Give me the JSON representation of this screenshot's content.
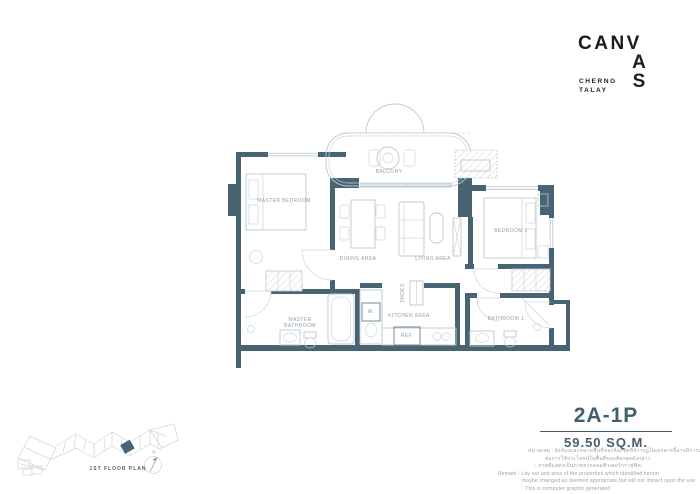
{
  "brand": {
    "logo_row": "CANV",
    "logo_stack_a": "A",
    "logo_stack_s": "S",
    "subtitle_line1": "CHERNG",
    "subtitle_line2": "TALAY"
  },
  "unit": {
    "code": "2A-1P",
    "area": "59.50 SQ.M."
  },
  "rooms": {
    "master_bedroom": "MASTER BEDROOM",
    "balcony": "BALCONY",
    "dining_area": "DINING AREA",
    "living_area": "LIVING AREA",
    "bedroom_1": "BEDROOM 1",
    "master_bathroom_line1": "MASTER",
    "master_bathroom_line2": "BATHROOM",
    "kitchen_area": "KITCHEN AREA",
    "bathroom_1": "BATHROOM 1",
    "shoes": "SHOES",
    "washer": "W.",
    "refrigerator": "REF."
  },
  "remark": {
    "thai_line1": "หมายเหตุ : ผังห้องและขนาดพื้นที่ของห้องชุดที่ปรากฏในเอกสารนี้อาจมีการเปลี่ยนแปลงได้ตามความเหมาะสม ทั้งนี้ไม่มีผลกระทบ",
    "thai_line2": "ต่อการใช้ประโยชน์ในพื้นที่ของห้องชุดดังกล่าว",
    "thai_line3": ": ภาพที่แสดงเป็นภาพจากคอมพิวเตอร์กราฟฟิค",
    "en_line1": "Remark : Lay out and area of the properties which identified herein",
    "en_line2": "maybe changed as deemed appropriate,but will not impact upon the use",
    "en_line3": ": This is computer graphic generated"
  },
  "siteplan": {
    "caption": "1ST FLOOR PLAN",
    "north": "N"
  },
  "colors": {
    "wall": "#486371",
    "furniture_line": "#bcc9d2",
    "accent_text": "#435f6e",
    "logo": "#1c1c1c",
    "label_text": "#90a0aa"
  }
}
